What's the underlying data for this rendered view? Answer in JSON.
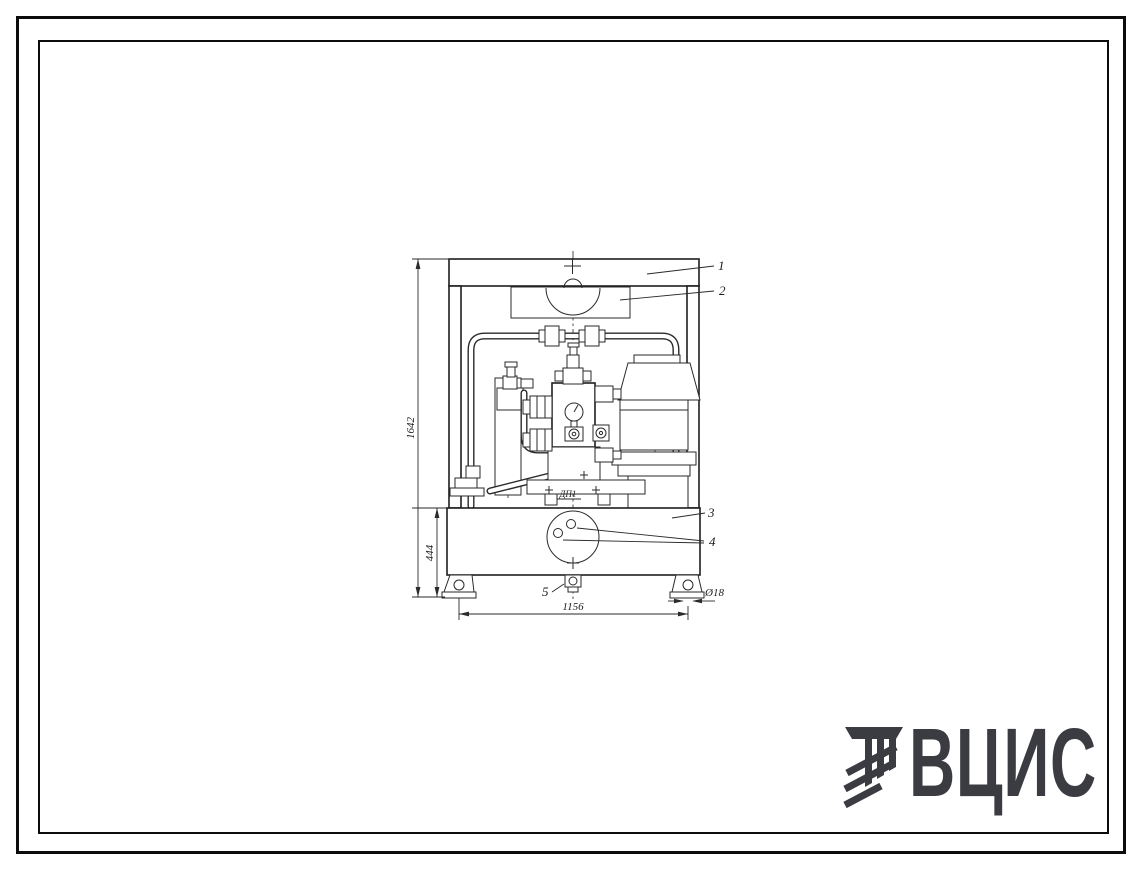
{
  "drawing": {
    "dimensions": {
      "overall_height": "1642",
      "tank_height": "444",
      "base_width": "1156",
      "hole_diameter": "Ø18"
    },
    "callouts": [
      "1",
      "2",
      "3",
      "4",
      "5"
    ],
    "component_label": "ДП1"
  },
  "logo": {
    "text": "ВЦИС",
    "color": "#3b3b42"
  }
}
